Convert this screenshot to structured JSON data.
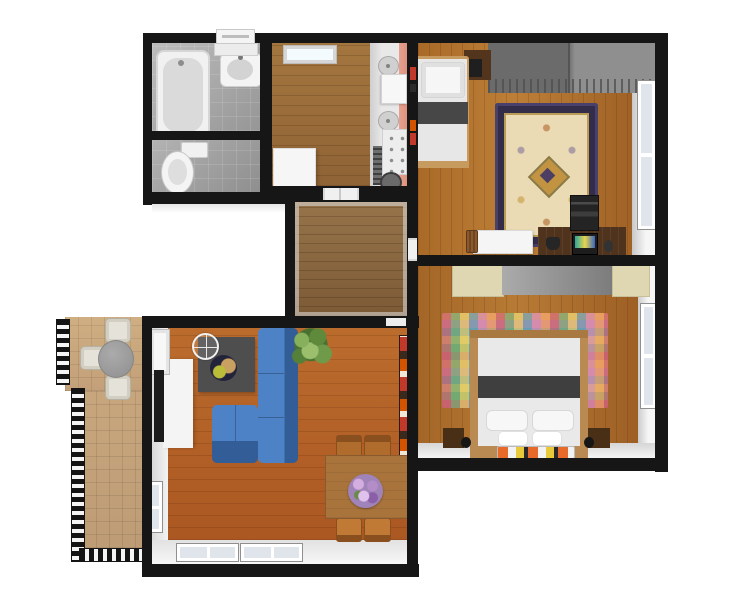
{
  "meta": {
    "type": "3d-floor-plan",
    "view": "top-down render",
    "background": "#ffffff",
    "text_on_image": "none"
  },
  "rooms": {
    "bathroom": {
      "name": "Bathroom",
      "floor": "gray tile",
      "furniture": [
        "bathtub",
        "washbasin",
        "wall shelf",
        "mirror cabinet"
      ]
    },
    "wc": {
      "name": "Toilet",
      "floor": "gray tile",
      "furniture": [
        "toilet"
      ]
    },
    "kitchen": {
      "name": "Kitchen",
      "floor": "wood",
      "furniture": [
        "ceiling light",
        "countertop",
        "two sinks",
        "cooktop with knobs",
        "oven grill",
        "refrigerator",
        "pink accent wall"
      ]
    },
    "hallway": {
      "name": "Hallway",
      "floor": "wood",
      "furniture": []
    },
    "bedroom1": {
      "name": "Bedroom 1",
      "floor": "wood",
      "furniture": [
        "single bed",
        "gray wardrobe",
        "dark dresser",
        "oriental rug",
        "desk",
        "printer",
        "laptop",
        "phone",
        "mouse",
        "open white door",
        "basket",
        "window",
        "red wall books"
      ]
    },
    "bedroom2": {
      "name": "Bedroom 2",
      "floor": "wood",
      "furniture": [
        "double bed",
        "gray wardrobe",
        "cream cabinet left",
        "cream cabinet right",
        "plaid rug",
        "nightstand left",
        "nightstand right",
        "bedside lamps",
        "striped runner rug",
        "window"
      ]
    },
    "living_room": {
      "name": "Living Room",
      "floor": "wood",
      "furniture": [
        "blue sectional sofa",
        "coffee table",
        "decorative bowl",
        "tv stand",
        "tv",
        "round mirror",
        "potted plant",
        "dining table",
        "flower vase",
        "four dining chairs",
        "book shelf strip",
        "two bottom windows",
        "side window",
        "balcony door"
      ]
    },
    "balcony": {
      "name": "Balcony",
      "floor": "tan tile",
      "furniture": [
        "round table",
        "three chairs",
        "lattice railing"
      ]
    }
  },
  "palette": {
    "wall": "#161616",
    "wood_living": "#b4612b",
    "wood_bedroom": "#b1722f",
    "wood_kitchen": "#9c6f3e",
    "wood_hall": "#8f6b42",
    "tile_bath": "#a9a9a9",
    "balcony_floor": "#c9a87f",
    "sofa_blue": "#3e74b8",
    "coffee_table_gray": "#4e4e4e",
    "wardrobe_gray": "#8a8a8a",
    "cabinet_cream": "#ded7b2",
    "rug_ornate_field": "#eadbb4",
    "rug_ornate_border": "#342d49",
    "rug_ornate_gold": "#c29340",
    "accent_wall_pink": "#e7a18e",
    "bookshelf_red": "#c0392b",
    "bed_linen_white": "#e9e9e9",
    "bed_band_gray": "#3f3f3f",
    "bed_frame_wood": "#b98b52",
    "dining_wood": "#a9743c",
    "chair_wood": "#b06c2c",
    "flower_purple": "#b48cc8",
    "plant_green": "#6f9a4a"
  }
}
